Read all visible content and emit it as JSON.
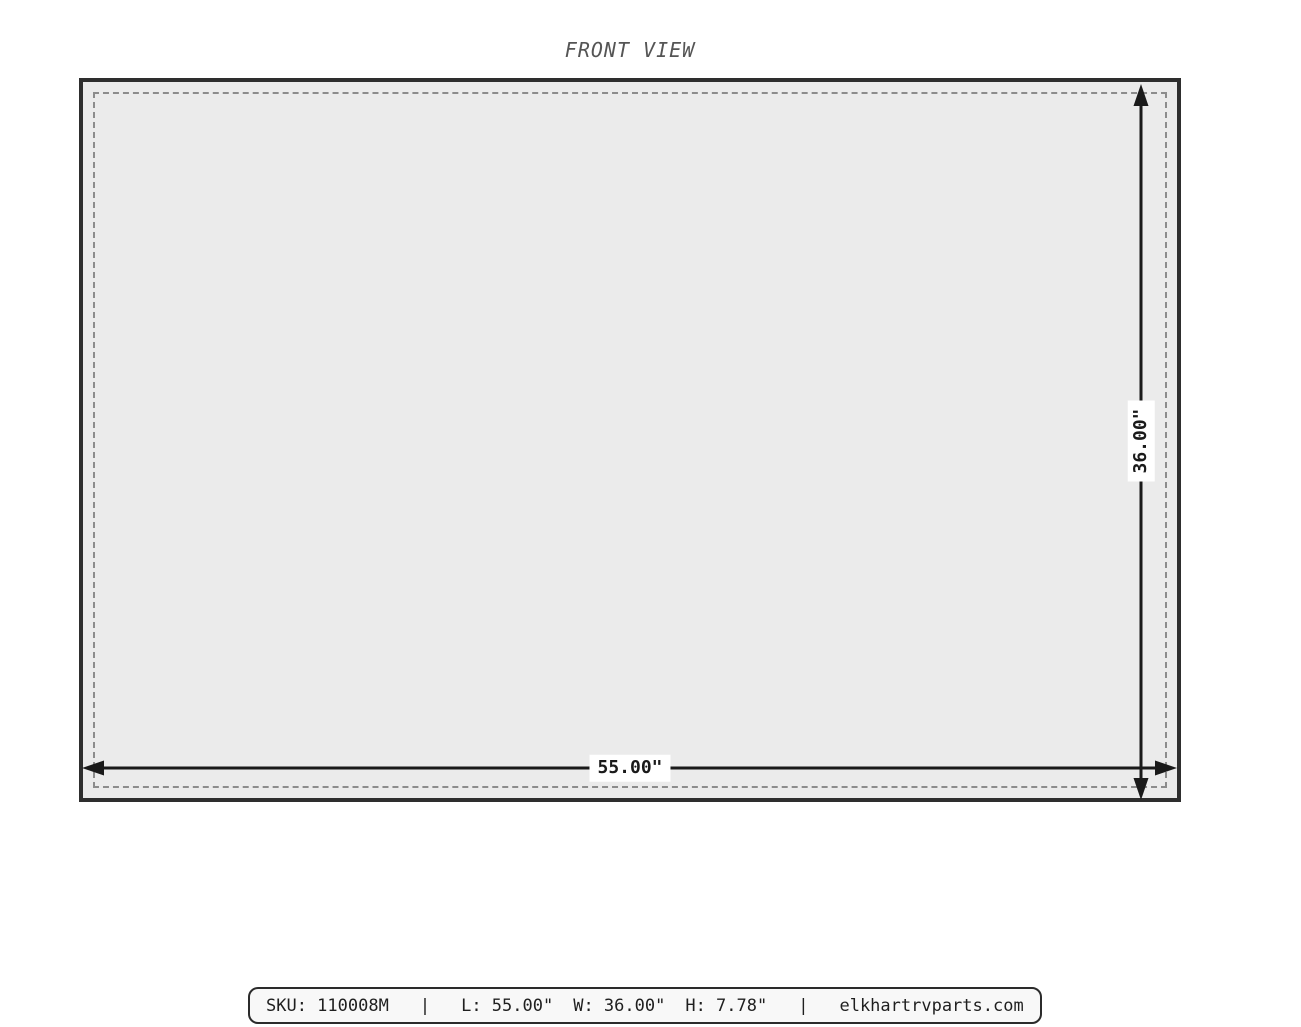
{
  "title": "FRONT VIEW",
  "panel": {
    "width_label": "55.00\"",
    "height_label": "36.00\""
  },
  "footer": {
    "segments": [
      "SKU: 110008M",
      "|",
      "L: 55.00\"",
      "W: 36.00\"",
      "H: 7.78\"",
      "|",
      "elkhartrvparts.com"
    ]
  },
  "colors": {
    "panel_fill": "#ebebeb",
    "panel_border": "#2e2e2e",
    "dashed_inset": "#8c8c8c",
    "dimension_lines": "#1a1a1a",
    "title_text": "#555555",
    "footer_background": "#f8f8f8",
    "footer_border": "#2b2b2b",
    "page_background": "#ffffff"
  }
}
